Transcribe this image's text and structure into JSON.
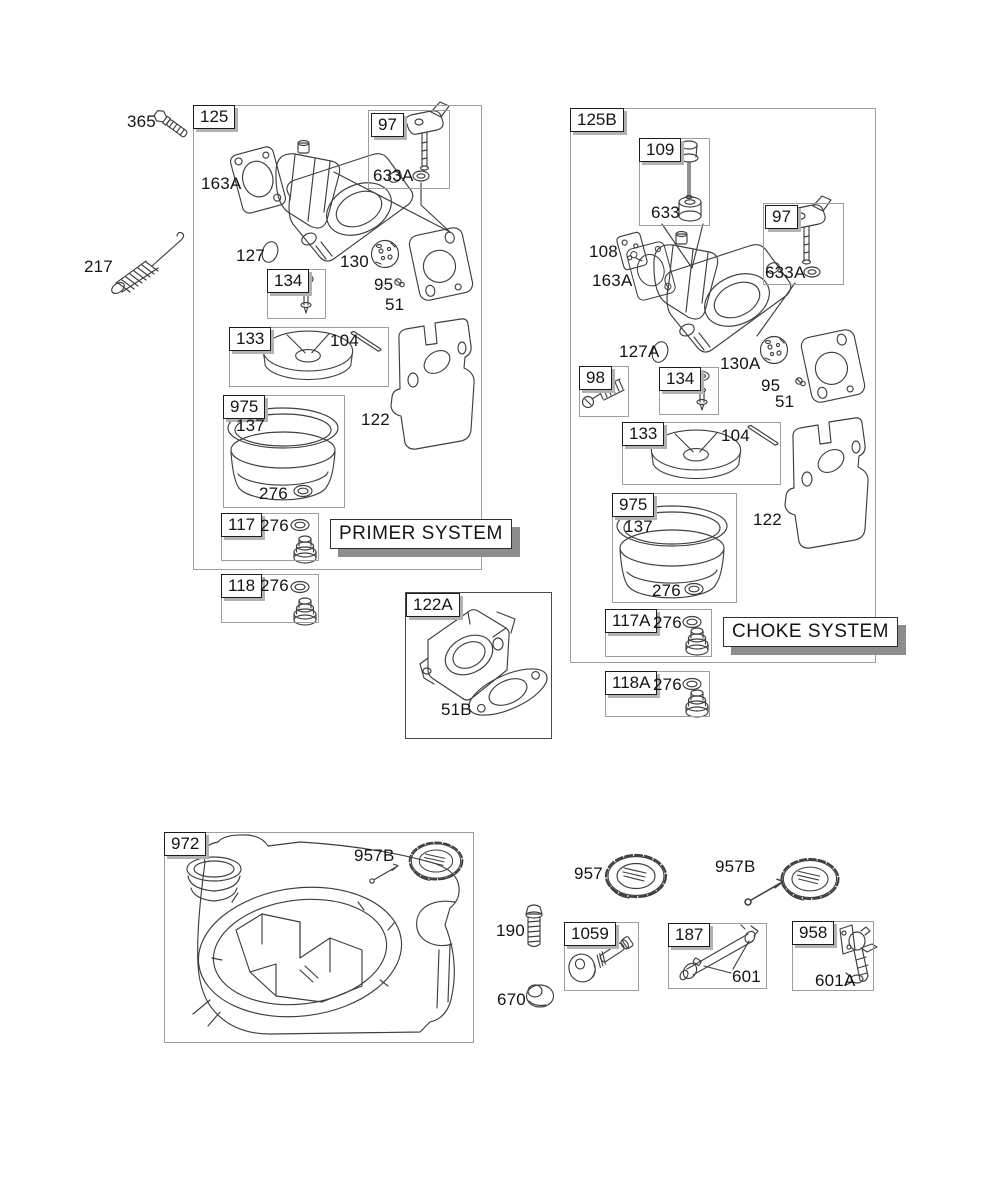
{
  "page": {
    "bg": "#ffffff",
    "ink": "#3f3f3f"
  },
  "primer": {
    "tag": "125",
    "banner": "PRIMER SYSTEM",
    "bolt": "365",
    "spring": "217",
    "intake_gasket": "163A",
    "throttle_shaft_box": "97",
    "shaft_seal": "633A",
    "welch_plug": "127",
    "needle_box": "134",
    "throttle_plate": "130",
    "plate_screw": "95",
    "carb_gasket": "51",
    "float_box": "133",
    "float_pin": "104",
    "bracket": "122",
    "bowl_box": "975",
    "bowl_gasket": "137",
    "bowl_seal": "276",
    "primer_box_117": "117",
    "seal_117": "276",
    "primer_box_118": "118",
    "seal_118": "276"
  },
  "spacer": {
    "tag": "122A",
    "gasket": "51B"
  },
  "choke": {
    "tag": "125B",
    "banner": "CHOKE SYSTEM",
    "needle_valve_box": "109",
    "bushing": "633",
    "pump_gasket": "108",
    "intake_gasket": "163A",
    "choke_shaft_box": "97",
    "shaft_seal": "633A",
    "welch_plug": "127A",
    "throttle_plate": "130A",
    "plate_screw": "95",
    "carb_gasket": "51",
    "spring_box": "98",
    "needle_box": "134",
    "float_box": "133",
    "float_pin": "104",
    "bracket": "122",
    "bowl_box": "975",
    "bowl_gasket": "137",
    "bowl_seal": "276",
    "choke_box_117a": "117A",
    "seal_117a": "276",
    "choke_box_118a": "118A",
    "seal_118a": "276"
  },
  "fuel": {
    "tank_box": "972",
    "tank_cap": "957B",
    "cap": "957",
    "cap_b": "957B",
    "bolt": "190",
    "screw_box": "1059",
    "spacer": "670",
    "line_box": "187",
    "clamp": "601",
    "valve_box": "958",
    "valve_clamp": "601A"
  }
}
